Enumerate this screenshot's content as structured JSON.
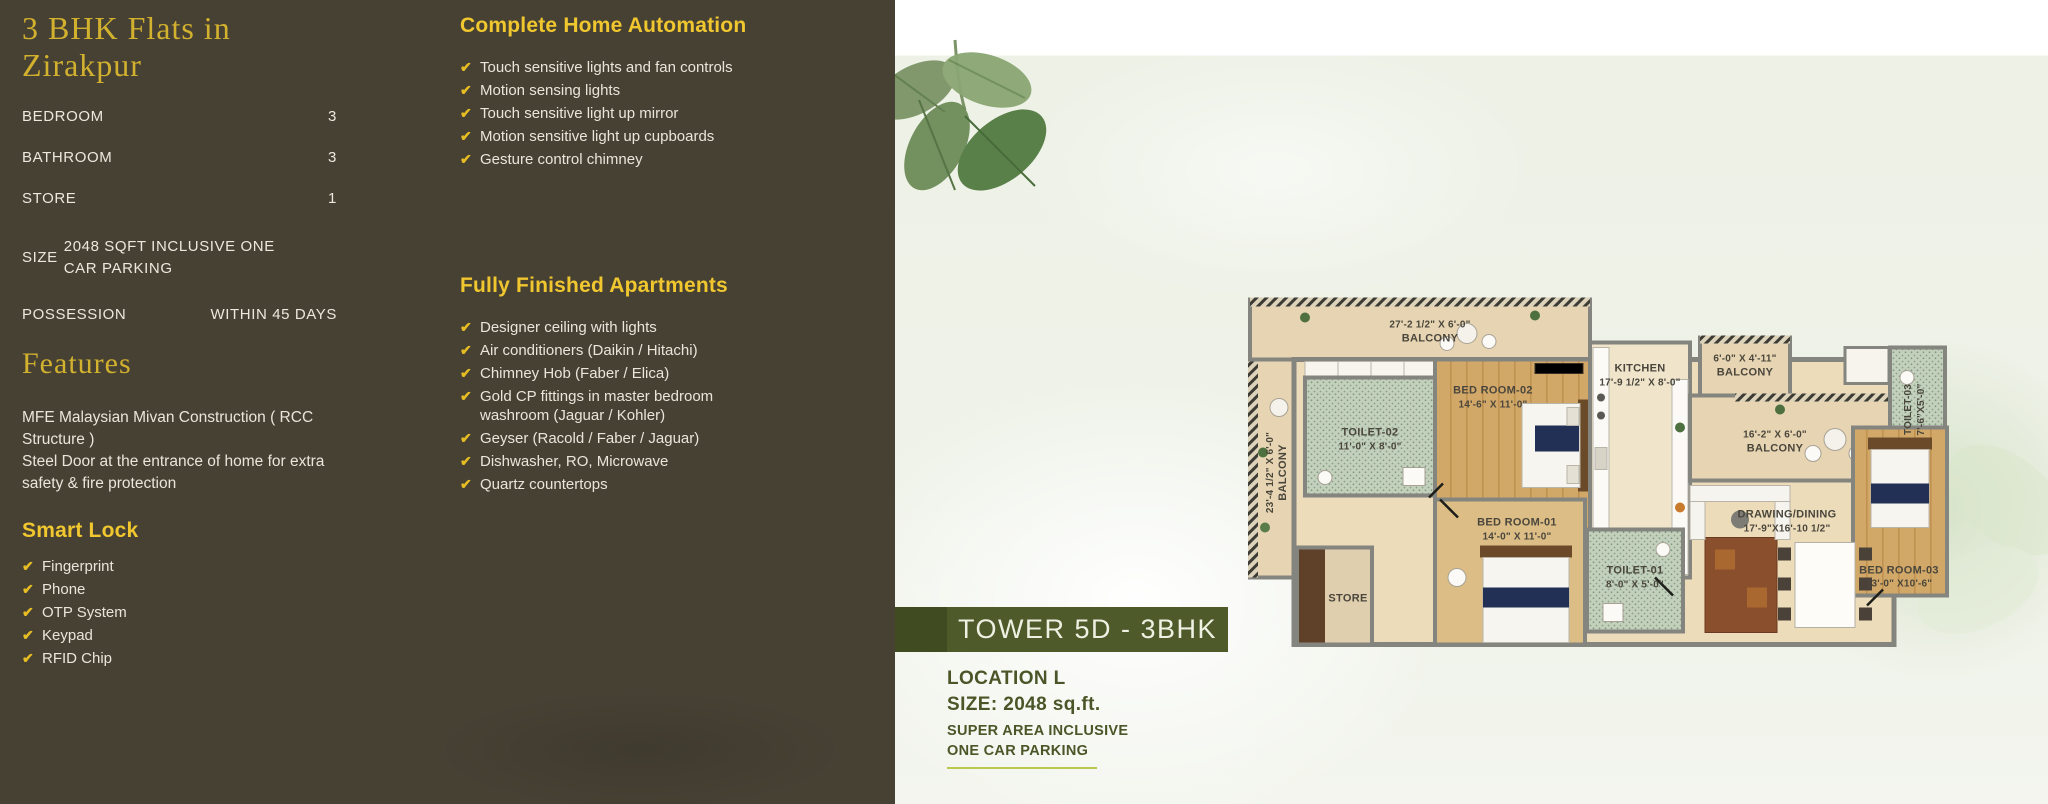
{
  "left_panel": {
    "title": "3 BHK Flats in Zirakpur",
    "specs": [
      {
        "label": "BEDROOM",
        "value": "3"
      },
      {
        "label": "BATHROOM",
        "value": "3"
      },
      {
        "label": "STORE",
        "value": "1"
      },
      {
        "label": "SIZE",
        "value": "2048 SQFT INCLUSIVE ONE CAR PARKING"
      },
      {
        "label": "POSSESSION",
        "value": "WITHIN 45 DAYS"
      }
    ],
    "features": {
      "title": "Features",
      "line1": "MFE Malaysian Mivan Construction ( RCC Structure )",
      "line2": "Steel Door at the entrance of home for extra safety & fire protection"
    },
    "smart_lock": {
      "title": "Smart Lock",
      "items": [
        "Fingerprint",
        "Phone",
        "OTP System",
        "Keypad",
        "RFID Chip"
      ]
    },
    "home_automation": {
      "title": "Complete Home Automation",
      "items": [
        "Touch sensitive lights and fan controls",
        "Motion sensing lights",
        "Touch sensitive light up mirror",
        "Motion sensitive light up cupboards",
        "Gesture control chimney"
      ]
    },
    "finished_apartments": {
      "title": "Fully Finished Apartments",
      "items": [
        "Designer ceiling with lights",
        "Air conditioners (Daikin / Hitachi)",
        "Chimney Hob (Faber / Elica)",
        "Gold CP fittings in master bedroom washroom (Jaguar / Kohler)",
        "Geyser (Racold / Faber / Jaguar)",
        "Dishwasher, RO, Microwave",
        "Quartz countertops"
      ]
    }
  },
  "right_panel": {
    "tower_banner": "TOWER 5D - 3BHK",
    "location": "LOCATION L",
    "size": "SIZE: 2048 sq.ft.",
    "note_line1": "SUPER AREA INCLUSIVE",
    "note_line2": "ONE CAR PARKING",
    "floor_plan": {
      "rooms": [
        {
          "name": "BALCONY",
          "dims": "27'-2 1/2\" X 6'-0\""
        },
        {
          "name": "BALCONY",
          "dims": "23'-4 1/2\" X 6'-0\""
        },
        {
          "name": "TOILET-02",
          "dims": "11'-0\" X 8'-0\""
        },
        {
          "name": "BED ROOM-02",
          "dims": "14'-6\" X 11'-0\""
        },
        {
          "name": "KITCHEN",
          "dims": "17'-9 1/2\" X 8'-0\""
        },
        {
          "name": "BALCONY",
          "dims": "6'-0\" X 4'-11\""
        },
        {
          "name": "BALCONY",
          "dims": "16'-2\" X 6'-0\""
        },
        {
          "name": "TOILET-03",
          "dims": "7'-6\"X5'-0\""
        },
        {
          "name": "BED ROOM-01",
          "dims": "14'-0\" X 11'-0\""
        },
        {
          "name": "TOILET-01",
          "dims": "8'-0\" X 5'-0\""
        },
        {
          "name": "STORE",
          "dims": ""
        },
        {
          "name": "DRAWING/DINING",
          "dims": "17'-9\"X16'-10 1/2\""
        },
        {
          "name": "BED ROOM-03",
          "dims": "13'-0\" X10'-6\""
        }
      ]
    }
  },
  "icons": {
    "check": "✔"
  },
  "colors": {
    "panel_bg": "#474134",
    "heading_gold": "#d2b12e",
    "heading_yellow": "#f0c72e",
    "text_light": "#e9e5da",
    "check_yellow": "#e7bd24",
    "banner_green": "#4f5a2a",
    "banner_green_dark": "#414b22",
    "location_green": "#4b5628",
    "underline_green": "#bac94e",
    "paper_green": "#edf1e6"
  }
}
